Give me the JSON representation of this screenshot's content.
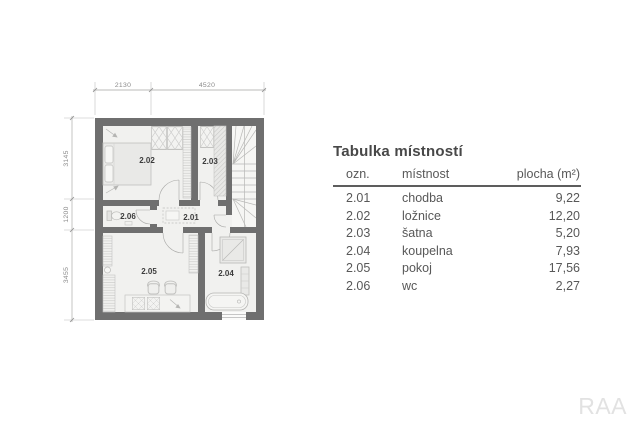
{
  "plan": {
    "rooms": [
      {
        "id": "2.01"
      },
      {
        "id": "2.02"
      },
      {
        "id": "2.03"
      },
      {
        "id": "2.04"
      },
      {
        "id": "2.05"
      },
      {
        "id": "2.06"
      }
    ],
    "dim_top": [
      "2130",
      "4520"
    ],
    "dim_left": [
      "3145",
      "1200",
      "3455"
    ]
  },
  "table": {
    "title": "Tabulka místností",
    "columns": {
      "ozn": "ozn.",
      "mistnost": "místnost",
      "plocha": "plocha (m²)"
    },
    "rows": [
      {
        "ozn": "2.01",
        "mistnost": "chodba",
        "plocha": "9,22"
      },
      {
        "ozn": "2.02",
        "mistnost": "ložnice",
        "plocha": "12,20"
      },
      {
        "ozn": "2.03",
        "mistnost": "šatna",
        "plocha": "5,20"
      },
      {
        "ozn": "2.04",
        "mistnost": "koupelna",
        "plocha": "7,93"
      },
      {
        "ozn": "2.05",
        "mistnost": "pokoj",
        "plocha": "17,56"
      },
      {
        "ozn": "2.06",
        "mistnost": "wc",
        "plocha": "2,27"
      }
    ]
  },
  "watermark": "RAA",
  "colors": {
    "wall": "#6f6f6f",
    "floor": "#f1f1ef",
    "furniture_stroke": "#c0c0be",
    "dimension": "#8f8f8f",
    "room_label": "#3c3c3c",
    "table_text": "#585858",
    "title_text": "#484848",
    "watermark": "#e2e2e2"
  }
}
